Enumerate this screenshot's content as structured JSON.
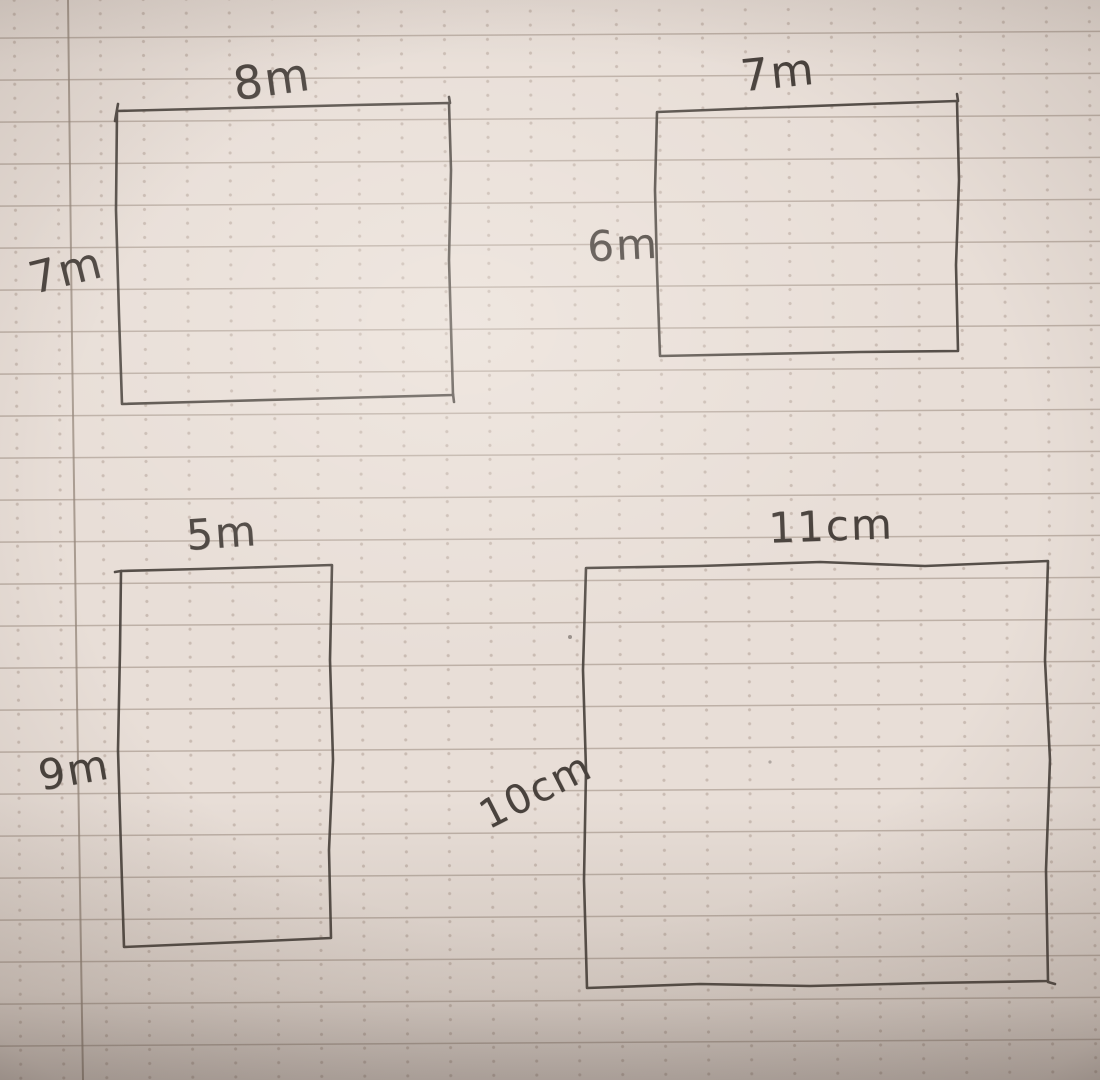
{
  "page": {
    "kind": "photograph of a handwritten maths worksheet",
    "paper": "ruled notebook paper with faint dot grid and left margin line"
  },
  "colors": {
    "paper": "#e8ded7",
    "ink": "#49423d",
    "rule_line": "#a3978d",
    "dot_grid": "#c9bcb3",
    "margin_line": "#9b8f86"
  },
  "rectangles": [
    {
      "id": "top-left",
      "top_label": "8m",
      "left_label": "7m"
    },
    {
      "id": "top-right",
      "top_label": "7m",
      "left_label": "6m"
    },
    {
      "id": "bottom-left",
      "top_label": "5m",
      "left_label": "9m"
    },
    {
      "id": "bottom-right",
      "top_label": "11cm",
      "left_label": "10cm"
    }
  ]
}
